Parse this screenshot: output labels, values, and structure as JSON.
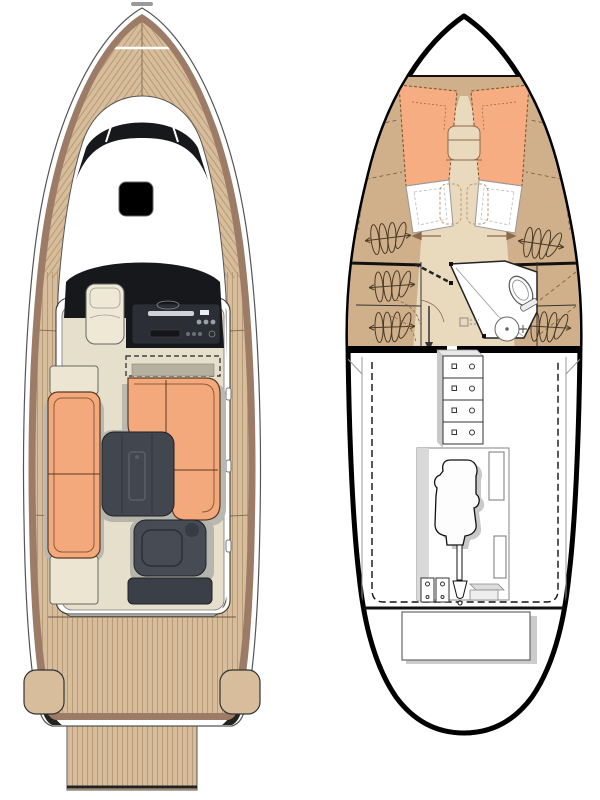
{
  "document": {
    "title": "Boat floor plan — deck and hull layout",
    "views": {
      "main_deck": {
        "label": "main-deck-plan",
        "areas": [
          "foredeck",
          "windshield",
          "roof-hatch",
          "helm-console",
          "copilot-seat",
          "l-shaped-sofa",
          "side-sofa",
          "cockpit-table",
          "aft-wet-bar",
          "side-decks",
          "aft-deck",
          "stern-lockers",
          "swim-platform"
        ]
      },
      "lower_deck": {
        "label": "lower-deck-plan",
        "areas": [
          "v-berth-cabin",
          "berth-mattresses",
          "hanging-lockers",
          "head-compartment",
          "toilet",
          "sink",
          "companionway-steps",
          "engine-room",
          "battery-bank",
          "engine",
          "propeller-shaft",
          "fuel-tank"
        ]
      }
    }
  },
  "colors": {
    "deck_teak": "#d7bd9b",
    "hull_rim": "#9c7b67",
    "sofa_orange": "#f4a97c",
    "berth_orange": "#f6ad82",
    "floor_beige": "#e5dfcc",
    "seat_beige": "#efe8d5",
    "table_dark": "#42464f",
    "module_dark": "#474b54",
    "glass_black": "#17181c",
    "console_dark": "#2b2e35",
    "shelf_tan": "#d0b08a",
    "aisle_beige": "#e9d9bd",
    "shadow_gray": "#b9b9b0",
    "engine_shadow": "#c9c9c9",
    "white": "#ffffff"
  }
}
